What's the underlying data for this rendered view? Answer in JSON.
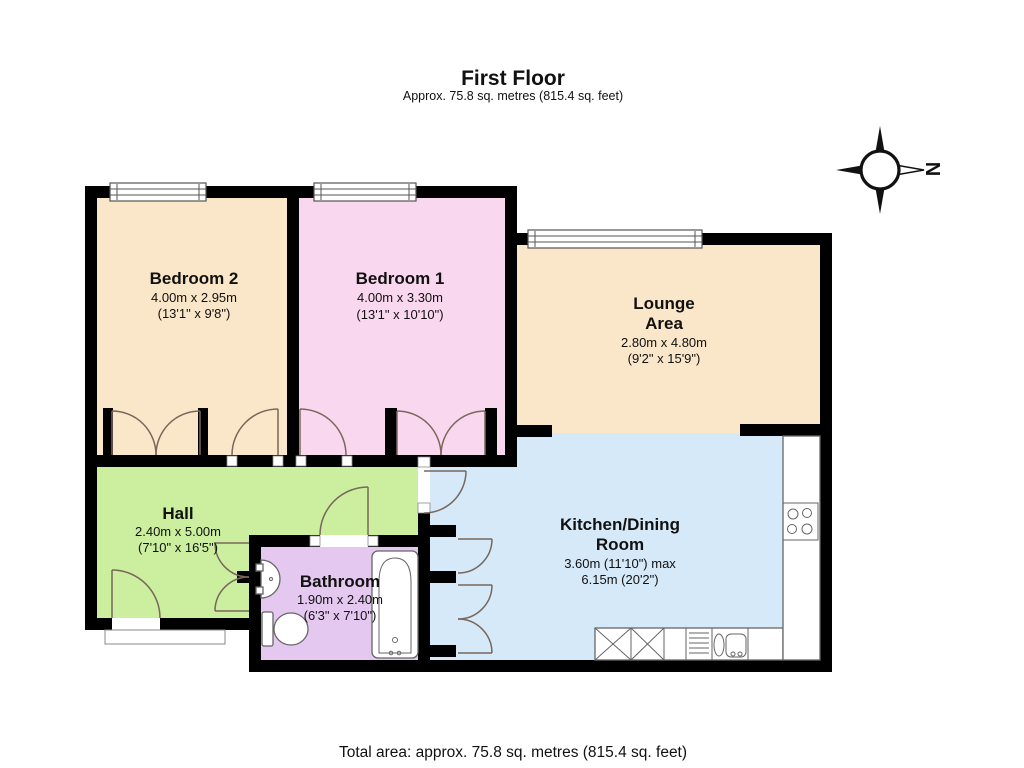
{
  "header": {
    "title": "First Floor",
    "subtitle": "Approx.  75.8 sq. metres (815.4 sq. feet)"
  },
  "footer": {
    "total_area": "Total area: approx.  75.8 sq. metres (815.4 sq. feet)"
  },
  "compass": {
    "label": "N",
    "direction_note": "north-pointer-rotated-right"
  },
  "rooms": [
    {
      "id": "bedroom2",
      "name": "Bedroom 2",
      "dimensions_metric": "4.00m x 2.95m",
      "dimensions_imperial": "(13'1\" x 9'8\")",
      "color": "#fae6c8"
    },
    {
      "id": "bedroom1",
      "name": "Bedroom 1",
      "dimensions_metric": "4.00m x 3.30m",
      "dimensions_imperial": "(13'1\" x 10'10\")",
      "color": "#f9d8ef"
    },
    {
      "id": "lounge",
      "name": "Lounge Area",
      "name_line1": "Lounge",
      "name_line2": "Area",
      "dimensions_metric": "2.80m x 4.80m",
      "dimensions_imperial": "(9'2\" x 15'9\")",
      "color": "#fae6c8"
    },
    {
      "id": "hall",
      "name": "Hall",
      "dimensions_metric": "2.40m x 5.00m",
      "dimensions_imperial": "(7'10\" x 16'5\")",
      "color": "#cbef9e"
    },
    {
      "id": "bathroom",
      "name": "Bathroom",
      "dimensions_metric": "1.90m x 2.40m",
      "dimensions_imperial": "(6'3\" x 7'10\")",
      "color": "#e5c8f0"
    },
    {
      "id": "kitchen",
      "name": "Kitchen/Dining Room",
      "name_line1": "Kitchen/Dining",
      "name_line2": "Room",
      "dimensions_metric": "3.60m (11'10\") max",
      "dimensions_imperial": "6.15m (20'2\")",
      "color": "#d5e9f8"
    }
  ],
  "colors": {
    "wall": "#000000",
    "door_arc": "#7a675c",
    "fixture_stroke": "#666666",
    "background": "#ffffff"
  }
}
